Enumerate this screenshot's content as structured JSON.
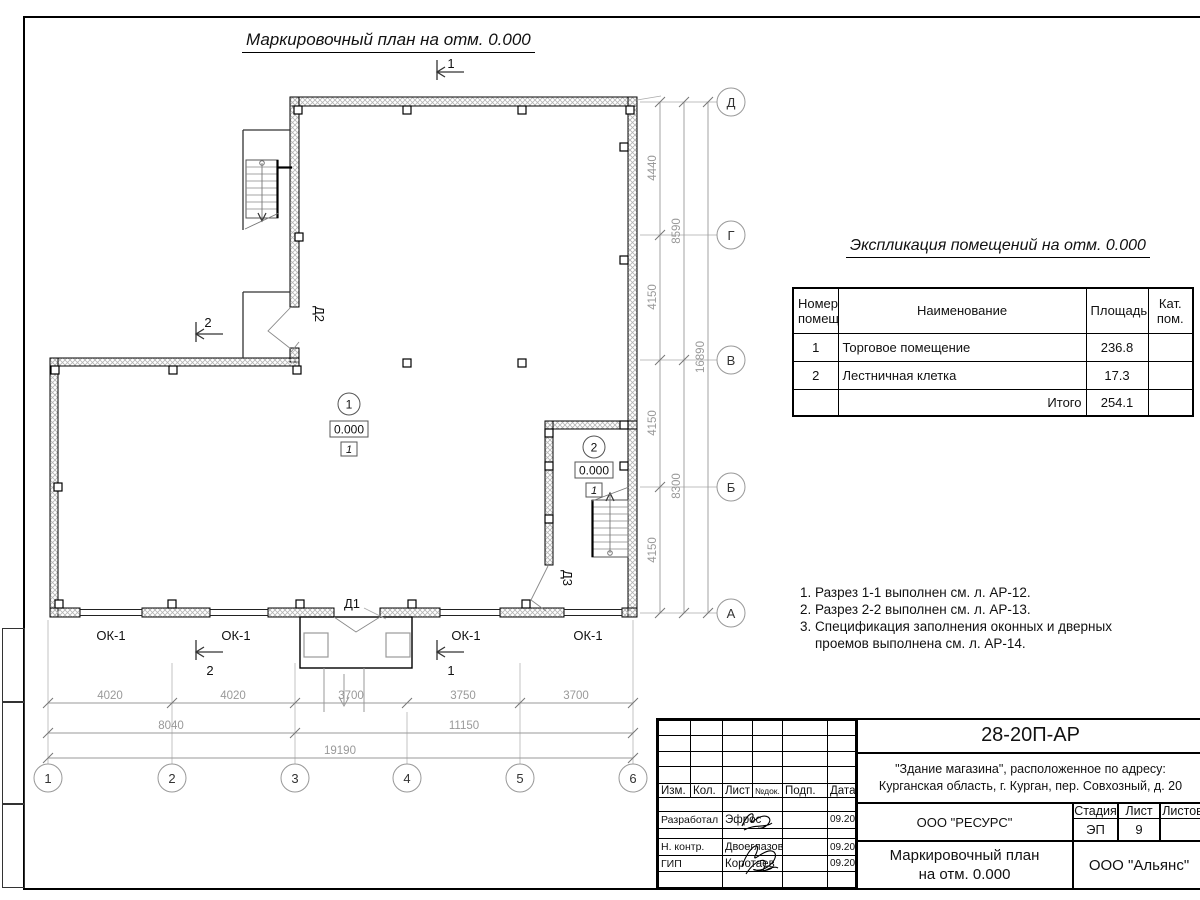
{
  "plan": {
    "title": "Маркировочный план на отм. 0.000",
    "window_label": "ОК-1",
    "doors": {
      "d1": "Д1",
      "d2": "Д2",
      "d3": "Д3"
    },
    "rooms": [
      {
        "number": "1",
        "elevation": "0.000",
        "floor_type": "1"
      },
      {
        "number": "2",
        "elevation": "0.000",
        "floor_type": "1"
      }
    ],
    "section_marks": {
      "s1": "1",
      "s2": "2"
    }
  },
  "axes": {
    "bottom": [
      "1",
      "2",
      "3",
      "4",
      "5",
      "6"
    ],
    "right": [
      "Д",
      "Г",
      "В",
      "Б",
      "А"
    ]
  },
  "dimensions": {
    "bottom_segments": [
      "4020",
      "4020",
      "3700",
      "3750",
      "3700"
    ],
    "bottom_sums": [
      "8040",
      "11150"
    ],
    "bottom_total": "19190",
    "right_segments": [
      "4440",
      "4150",
      "4150",
      "4150"
    ],
    "right_sums": [
      "8590",
      "8300"
    ],
    "right_total": "16890"
  },
  "explication": {
    "title": "Экспликация помещений на отм. 0.000",
    "headers": [
      "Номер помещ.",
      "Наименование",
      "Площадь",
      "Кат. пом."
    ],
    "rows": [
      {
        "num": "1",
        "name": "Торговое помещение",
        "area": "236.8",
        "cat": ""
      },
      {
        "num": "2",
        "name": "Лестничная клетка",
        "area": "17.3",
        "cat": ""
      }
    ],
    "total_label": "Итого",
    "total_area": "254.1"
  },
  "notes": [
    "1. Разрез 1-1 выполнен см. л. АР-12.",
    "2. Разрез 2-2 выполнен см. л. АР-13.",
    "3. Спецификация заполнения оконных и дверных",
    "проемов выполнена см. л. АР-14."
  ],
  "title_block": {
    "code": "28-20П-АР",
    "object_line1": "\"Здание магазина\", расположенное по адресу:",
    "object_line2": "Курганская область, г. Курган, пер. Совхозный, д. 20",
    "cols": [
      "Изм.",
      "Кол.",
      "Лист",
      "№док.",
      "Подп.",
      "Дата"
    ],
    "rows": [
      {
        "role": "Разработал",
        "name": "Эфрос",
        "date": "09.20"
      },
      {
        "role": "Н. контр.",
        "name": "Двоеглазов",
        "date": "09.20"
      },
      {
        "role": "ГИП",
        "name": "Коротаев",
        "date": "09.20"
      }
    ],
    "designer_org": "ООО \"РЕСУРС\"",
    "stage_label": "Стадия",
    "sheet_label": "Лист",
    "sheets_label": "Листов",
    "stage": "ЭП",
    "sheet": "9",
    "sheets": "",
    "doc_title_line1": "Маркировочный план",
    "doc_title_line2": "на отм. 0.000",
    "contractor_org": "ООО \"Альянс\""
  }
}
